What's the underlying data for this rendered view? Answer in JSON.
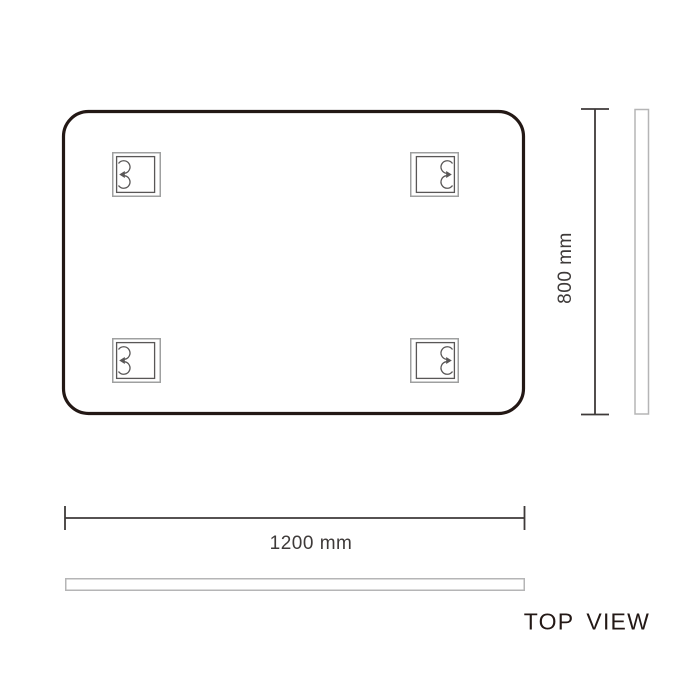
{
  "view": {
    "title": "TOP VIEW"
  },
  "dimensions": {
    "width_label": "1200 mm",
    "height_label": "800 mm"
  },
  "panel": {
    "shape": "rounded-rectangle",
    "outline_color": "#231815",
    "fill_color": "#ffffff"
  },
  "brackets": {
    "count": 4,
    "icon": "keyhole-mount-bracket-icon",
    "frame_color": "#9fa0a0",
    "detail_color": "#595757"
  },
  "profiles": {
    "outline_color": "#b5b5b6"
  },
  "dimension_style": {
    "line_color": "#3e3a39",
    "text_color": "#3e3a39"
  },
  "background_color": "#ffffff"
}
